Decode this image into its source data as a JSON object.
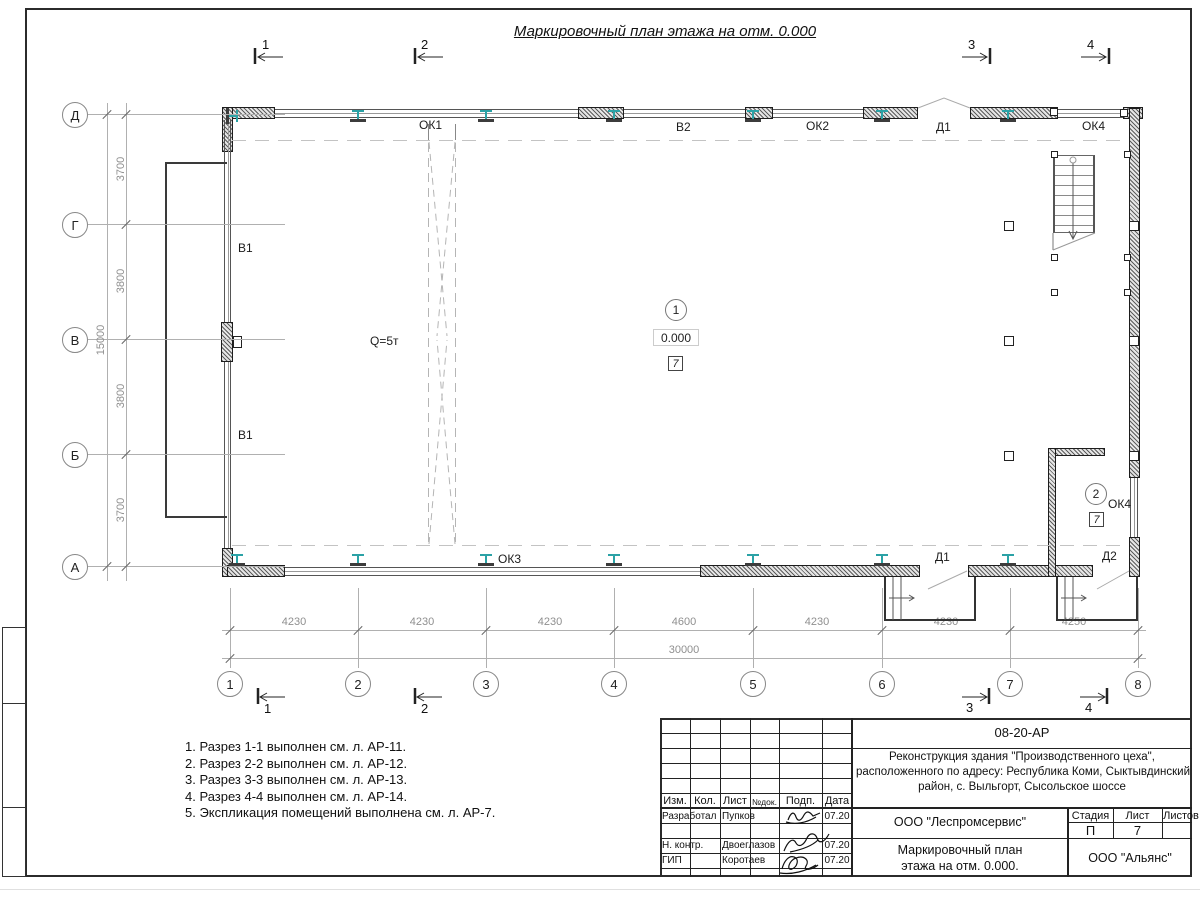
{
  "sheet": {
    "title": "Маркировочный план этажа на отм. 0.000"
  },
  "axes": {
    "rows": [
      "Д",
      "Г",
      "В",
      "Б",
      "А"
    ],
    "cols": [
      "1",
      "2",
      "3",
      "4",
      "5",
      "6",
      "7",
      "8"
    ]
  },
  "dimensions": {
    "left_segments": [
      "3700",
      "3800",
      "3800",
      "3700"
    ],
    "left_total": "15000",
    "bottom_segments": [
      "4230",
      "4230",
      "4230",
      "4600",
      "4230",
      "4230",
      "4250"
    ],
    "bottom_total": "30000"
  },
  "marks": {
    "ok1": "ОК1",
    "v2": "В2",
    "ok2": "ОК2",
    "d1_top": "Д1",
    "ok4_top": "ОК4",
    "v1_upper": "В1",
    "v1_lower": "В1",
    "crane": "Q=5т",
    "ok3": "ОК3",
    "d1_bottom": "Д1",
    "d2": "Д2",
    "ok4_room": "ОК4"
  },
  "rooms": {
    "r1": {
      "number": "1",
      "elevation": "0.000",
      "type_mark": "7"
    },
    "r2": {
      "number": "2",
      "type_mark": "7"
    }
  },
  "sections": {
    "s1": "1",
    "s2": "2",
    "s3": "3",
    "s4": "4"
  },
  "notes": [
    "1. Разрез 1-1 выполнен см. л. АР-11.",
    "2. Разрез 2-2 выполнен см. л. АР-12.",
    "3. Разрез 3-3 выполнен см. л. АР-13.",
    "4. Разрез 4-4 выполнен см. л. АР-14.",
    "5. Экспликация помещений выполнена см. л. АР-7."
  ],
  "title_block": {
    "doc_number": "08-20-АР",
    "project_lines": [
      "Реконструкция здания \"Производственного цеха\",",
      "расположенного по адресу: Республика Коми, Сыктывдинский",
      "район, с. Выльгорт, Сысольское шоссе"
    ],
    "columns": [
      "Изм.",
      "Кол.",
      "Лист",
      "№док.",
      "Подп.",
      "Дата"
    ],
    "org": "ООО \"Леспромсервис\"",
    "title_lines": [
      "Маркировочный план",
      "этажа на отм. 0.000."
    ],
    "stage_label": "Стадия",
    "sheet_label": "Лист",
    "sheets_label": "Листов",
    "stage": "П",
    "sheet_number": "7",
    "company": "ООО \"Альянс\"",
    "roles": [
      {
        "role": "Разработал",
        "name": "Пупков",
        "date": "07.20"
      },
      {
        "role": "Н. контр.",
        "name": "Двоеглазов",
        "date": "07.20"
      },
      {
        "role": "ГИП",
        "name": "Коротаев",
        "date": "07.20"
      }
    ]
  },
  "colors": {
    "steel_column": "#2ba2a6",
    "wall_line": "#222222",
    "dim_text": "#8f8f8f"
  }
}
